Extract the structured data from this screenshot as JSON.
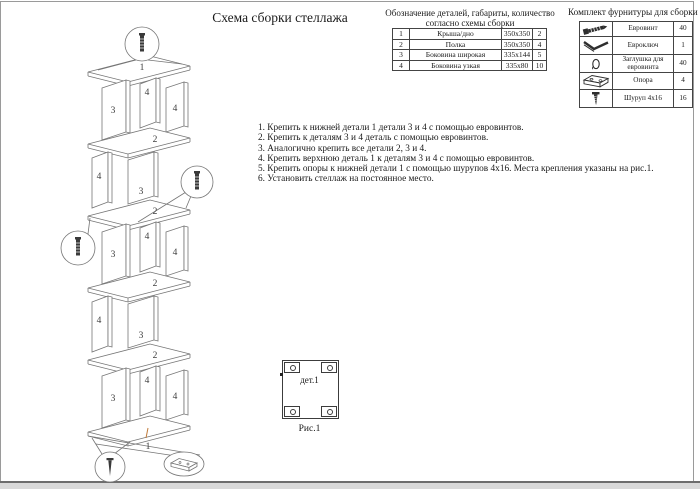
{
  "page": {
    "title": "Схема сборки стеллажа"
  },
  "parts_table": {
    "caption_line1": "Обозначение деталей, габариты, количество",
    "caption_line2": "согласно схемы сборки",
    "rows": [
      {
        "num": "1",
        "name": "Крыша/дно",
        "size": "350х350",
        "qty": "2"
      },
      {
        "num": "2",
        "name": "Полка",
        "size": "350х350",
        "qty": "4"
      },
      {
        "num": "3",
        "name": "Боковина широкая",
        "size": "335х144",
        "qty": "5"
      },
      {
        "num": "4",
        "name": "Боковина узкая",
        "size": "335х80",
        "qty": "10"
      }
    ]
  },
  "hardware_table": {
    "caption": "Комплект фурнитуры для сборки",
    "rows": [
      {
        "icon": "eurovint-icon",
        "name": "Евровинт",
        "qty": "40"
      },
      {
        "icon": "hexkey-icon",
        "name": "Евроключ",
        "qty": "1"
      },
      {
        "icon": "cap-icon",
        "name": "Заглушка для евровинта",
        "qty": "40"
      },
      {
        "icon": "support-icon",
        "name": "Опора",
        "qty": "4"
      },
      {
        "icon": "screw-icon",
        "name": "Шуруп 4х16",
        "qty": "16"
      }
    ]
  },
  "instructions": [
    "1. Крепить к нижней детали 1 детали 3 и 4 с помощью евровинтов.",
    "2. Крепить к деталям 3 и 4 деталь с помощью евровинтов.",
    "3. Аналогично крепить все детали 2, 3 и 4.",
    "4. Крепить верхнюю деталь 1 к деталям 3 и 4 с помощью евровинтов.",
    "5. Крепить опоры к нижней детали 1 с помощью шурупов 4х16. Места крепления указаны на рис.1.",
    "6. Установить стеллаж на постоянное место."
  ],
  "figure": {
    "label": "дет.1",
    "caption": "Рис.1"
  },
  "diagram": {
    "top_panel_label": "1",
    "shelf_label": "2",
    "wide_side_label": "3",
    "narrow_side_label": "4",
    "bottom_panel_label": "1",
    "callout_icons": [
      "eurovint-icon",
      "eurovint-icon",
      "eurovint-icon",
      "screw-icon",
      "support-icon"
    ],
    "line_color": "#757575",
    "label_color": "#3d3d3d",
    "leader_accent_color": "#c07a3a"
  }
}
